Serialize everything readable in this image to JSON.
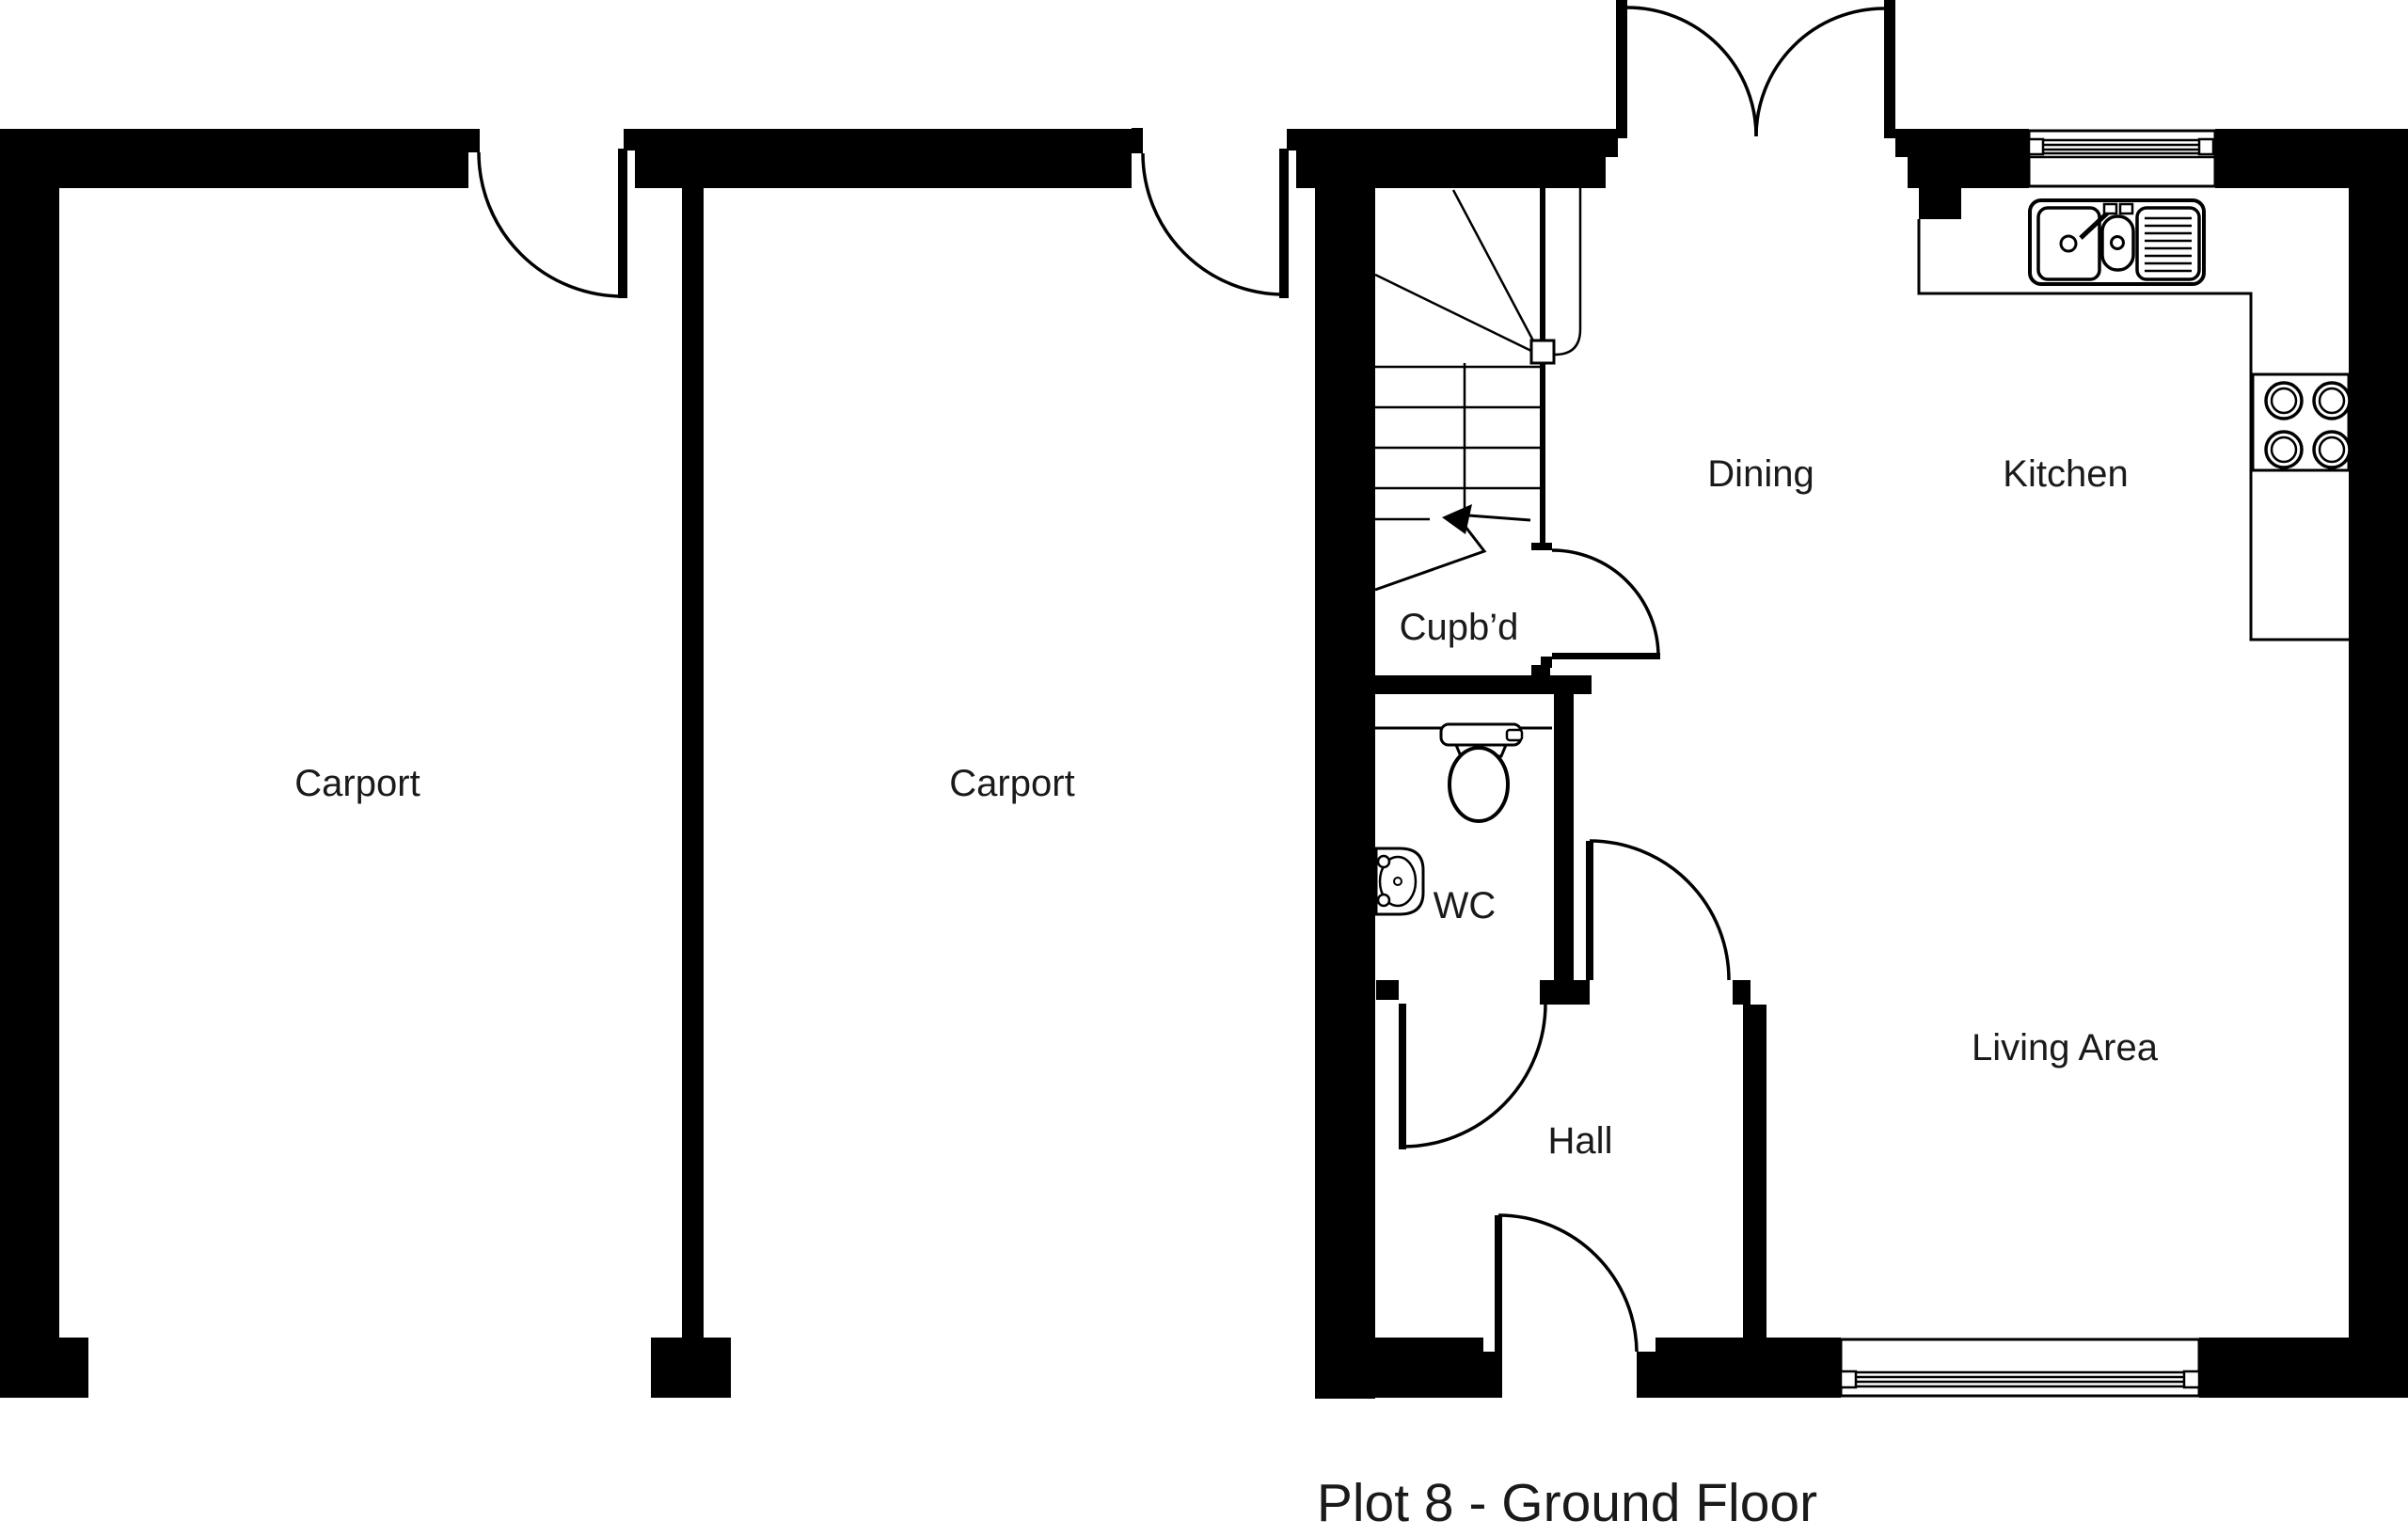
{
  "plan": {
    "title": "Plot 8 - Ground Floor",
    "rooms": {
      "carport_left": "Carport",
      "carport_right": "Carport",
      "dining": "Dining",
      "kitchen": "Kitchen",
      "cupboard": "Cupb’d",
      "wc": "WC",
      "hall": "Hall",
      "living": "Living Area"
    },
    "colors": {
      "wall": "#000000",
      "line": "#000000",
      "label_text": "#1a1a1a",
      "background": "#ffffff"
    }
  }
}
